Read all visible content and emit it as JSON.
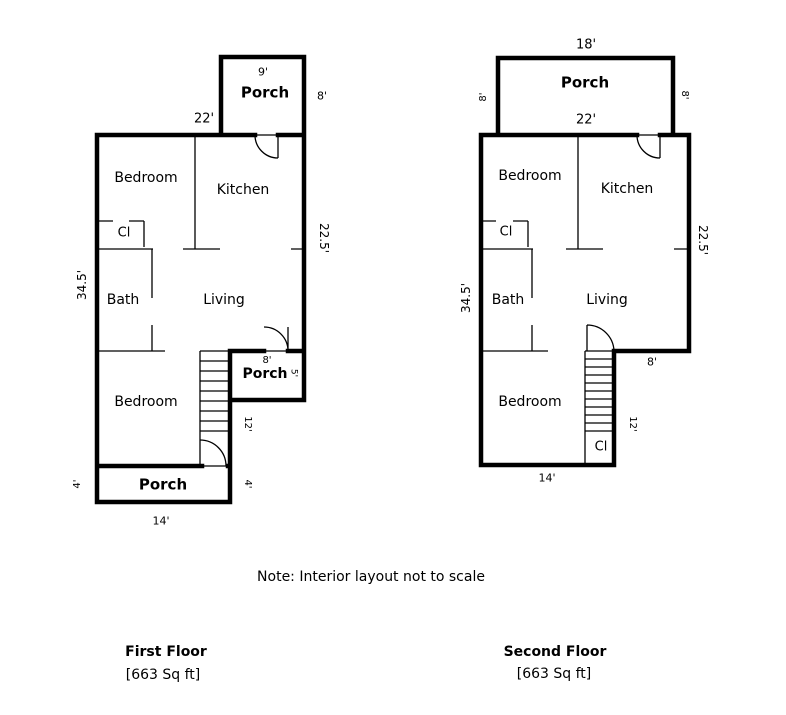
{
  "note": "Note: Interior layout not to scale",
  "colors": {
    "wall": "#000000",
    "background": "#ffffff",
    "text": "#000000"
  },
  "floors": [
    {
      "id": "first-floor",
      "caption_title": "First Floor",
      "caption_area": "[663 Sq ft]",
      "labels": [
        {
          "name": "first-floor-dim-top-porch-width",
          "text": "9'",
          "x": 263,
          "y": 72,
          "size": 11,
          "bold": false,
          "rotate": 0
        },
        {
          "name": "first-floor-room-label-top-porch",
          "text": "Porch",
          "x": 265,
          "y": 93,
          "size": 15,
          "bold": true,
          "rotate": 0
        },
        {
          "name": "first-floor-dim-top-porch-depth",
          "text": "8'",
          "x": 322,
          "y": 96,
          "size": 11,
          "bold": false,
          "rotate": 0
        },
        {
          "name": "first-floor-dim-main-width",
          "text": "22'",
          "x": 204,
          "y": 119,
          "size": 13,
          "bold": false,
          "rotate": 0
        },
        {
          "name": "first-floor-room-label-bedroom-upper",
          "text": "Bedroom",
          "x": 146,
          "y": 178,
          "size": 14,
          "bold": false,
          "rotate": 0
        },
        {
          "name": "first-floor-room-label-kitchen",
          "text": "Kitchen",
          "x": 243,
          "y": 190,
          "size": 14,
          "bold": false,
          "rotate": 0
        },
        {
          "name": "first-floor-room-label-closet",
          "text": "Cl",
          "x": 124,
          "y": 233,
          "size": 13,
          "bold": false,
          "rotate": 0
        },
        {
          "name": "first-floor-dim-left-height",
          "text": "34.5'",
          "x": 82,
          "y": 285,
          "size": 12,
          "bold": false,
          "rotate": -90
        },
        {
          "name": "first-floor-room-label-bath",
          "text": "Bath",
          "x": 123,
          "y": 300,
          "size": 14,
          "bold": false,
          "rotate": 0
        },
        {
          "name": "first-floor-room-label-living",
          "text": "Living",
          "x": 224,
          "y": 300,
          "size": 14,
          "bold": false,
          "rotate": 0
        },
        {
          "name": "first-floor-dim-right-height",
          "text": "22.5'",
          "x": 324,
          "y": 238,
          "size": 12,
          "bold": false,
          "rotate": 90
        },
        {
          "name": "first-floor-dim-mid-porch-width",
          "text": "8'",
          "x": 267,
          "y": 361,
          "size": 10,
          "bold": false,
          "rotate": 0
        },
        {
          "name": "first-floor-room-label-mid-porch",
          "text": "Porch",
          "x": 265,
          "y": 374,
          "size": 14,
          "bold": true,
          "rotate": 0
        },
        {
          "name": "first-floor-dim-mid-porch-depth",
          "text": "5'",
          "x": 293,
          "y": 373,
          "size": 9,
          "bold": false,
          "rotate": 90
        },
        {
          "name": "first-floor-room-label-bedroom-lower",
          "text": "Bedroom",
          "x": 146,
          "y": 402,
          "size": 14,
          "bold": false,
          "rotate": 0
        },
        {
          "name": "first-floor-dim-stairs-height",
          "text": "12'",
          "x": 247,
          "y": 424,
          "size": 10,
          "bold": false,
          "rotate": 90
        },
        {
          "name": "first-floor-dim-bottom-porch-depth-left",
          "text": "4'",
          "x": 78,
          "y": 484,
          "size": 10,
          "bold": false,
          "rotate": -90
        },
        {
          "name": "first-floor-room-label-bottom-porch",
          "text": "Porch",
          "x": 163,
          "y": 485,
          "size": 15,
          "bold": true,
          "rotate": 0
        },
        {
          "name": "first-floor-dim-bottom-porch-depth-right",
          "text": "4'",
          "x": 247,
          "y": 484,
          "size": 10,
          "bold": false,
          "rotate": 90
        },
        {
          "name": "first-floor-dim-bottom-porch-width",
          "text": "14'",
          "x": 161,
          "y": 521,
          "size": 11,
          "bold": false,
          "rotate": 0
        }
      ]
    },
    {
      "id": "second-floor",
      "caption_title": "Second Floor",
      "caption_area": "[663 Sq ft]",
      "labels": [
        {
          "name": "second-floor-dim-top-porch-width",
          "text": "18'",
          "x": 586,
          "y": 45,
          "size": 13,
          "bold": false,
          "rotate": 0
        },
        {
          "name": "second-floor-room-label-top-porch",
          "text": "Porch",
          "x": 585,
          "y": 83,
          "size": 15,
          "bold": true,
          "rotate": 0
        },
        {
          "name": "second-floor-dim-top-porch-depth-left",
          "text": "8'",
          "x": 484,
          "y": 97,
          "size": 10,
          "bold": false,
          "rotate": -90
        },
        {
          "name": "second-floor-dim-top-porch-depth-right",
          "text": "8'",
          "x": 684,
          "y": 95,
          "size": 10,
          "bold": false,
          "rotate": 90
        },
        {
          "name": "second-floor-dim-main-width",
          "text": "22'",
          "x": 586,
          "y": 120,
          "size": 13,
          "bold": false,
          "rotate": 0
        },
        {
          "name": "second-floor-room-label-bedroom-upper",
          "text": "Bedroom",
          "x": 530,
          "y": 176,
          "size": 14,
          "bold": false,
          "rotate": 0
        },
        {
          "name": "second-floor-room-label-kitchen",
          "text": "Kitchen",
          "x": 627,
          "y": 189,
          "size": 14,
          "bold": false,
          "rotate": 0
        },
        {
          "name": "second-floor-room-label-closet-upper",
          "text": "Cl",
          "x": 506,
          "y": 232,
          "size": 13,
          "bold": false,
          "rotate": 0
        },
        {
          "name": "second-floor-dim-left-height",
          "text": "34.5'",
          "x": 466,
          "y": 298,
          "size": 12,
          "bold": false,
          "rotate": -90
        },
        {
          "name": "second-floor-room-label-bath",
          "text": "Bath",
          "x": 508,
          "y": 300,
          "size": 14,
          "bold": false,
          "rotate": 0
        },
        {
          "name": "second-floor-room-label-living",
          "text": "Living",
          "x": 607,
          "y": 300,
          "size": 14,
          "bold": false,
          "rotate": 0
        },
        {
          "name": "second-floor-dim-right-height",
          "text": "22.5'",
          "x": 703,
          "y": 240,
          "size": 12,
          "bold": false,
          "rotate": 90
        },
        {
          "name": "second-floor-dim-notch-width",
          "text": "8'",
          "x": 652,
          "y": 362,
          "size": 11,
          "bold": false,
          "rotate": 0
        },
        {
          "name": "second-floor-room-label-bedroom-lower",
          "text": "Bedroom",
          "x": 530,
          "y": 402,
          "size": 14,
          "bold": false,
          "rotate": 0
        },
        {
          "name": "second-floor-dim-stairs-height",
          "text": "12'",
          "x": 632,
          "y": 424,
          "size": 10,
          "bold": false,
          "rotate": 90
        },
        {
          "name": "second-floor-room-label-closet-lower",
          "text": "Cl",
          "x": 601,
          "y": 447,
          "size": 13,
          "bold": false,
          "rotate": 0
        },
        {
          "name": "second-floor-dim-bottom-width",
          "text": "14'",
          "x": 547,
          "y": 478,
          "size": 11,
          "bold": false,
          "rotate": 0
        }
      ]
    }
  ]
}
